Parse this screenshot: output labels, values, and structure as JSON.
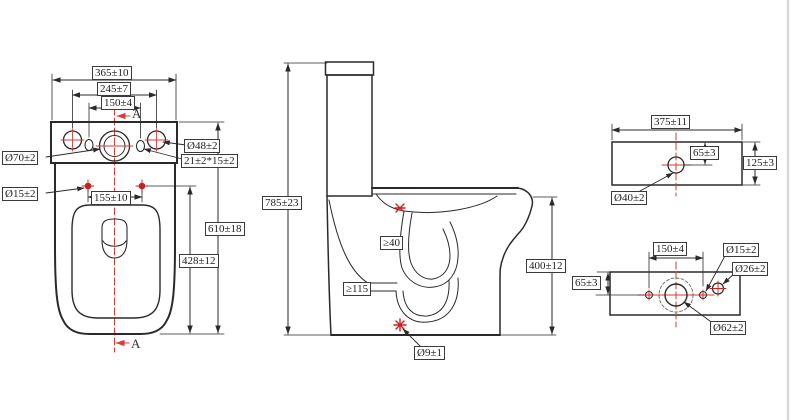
{
  "drawing": {
    "type": "technical-dimension-drawing",
    "subject": "two-piece toilet with cistern, orthographic views"
  },
  "colors": {
    "line": "#2a2a2a",
    "centerline_red": "#d93a36",
    "marker_red": "#cc1f1f",
    "page_edge": "#d8d8d8"
  },
  "views": {
    "front": {
      "dim_overall_width": "365±10",
      "dim_hole_spacing": "245±7",
      "dim_slot_spacing": "150±4",
      "section_marker_top": "A",
      "section_marker_bottom": "A",
      "label_dia_70": "Ø70±2",
      "label_dia_48": "Ø48±2",
      "label_slot": "21±2*15±2",
      "label_dia_15": "Ø15±2",
      "dim_seat_hole_spacing": "155±10",
      "dim_total_depth": "610±18",
      "dim_seat_depth": "428±12"
    },
    "side": {
      "dim_total_height": "785±23",
      "label_min_gap": "≥40",
      "label_min_trap": "≥115",
      "label_dia_9": "Ø9±1",
      "dim_rim_height": "400±12"
    },
    "tank_top": {
      "dim_width": "375±11",
      "dim_hole_offset": "65±3",
      "dim_depth": "125±3",
      "label_dia_40": "Ø40±2"
    },
    "tank_bottom": {
      "dim_hole_spacing": "150±4",
      "label_dia_15": "Ø15±2",
      "label_dia_26": "Ø26±2",
      "dim_hole_offset": "65±3",
      "label_dia_62": "Ø62±2"
    }
  }
}
